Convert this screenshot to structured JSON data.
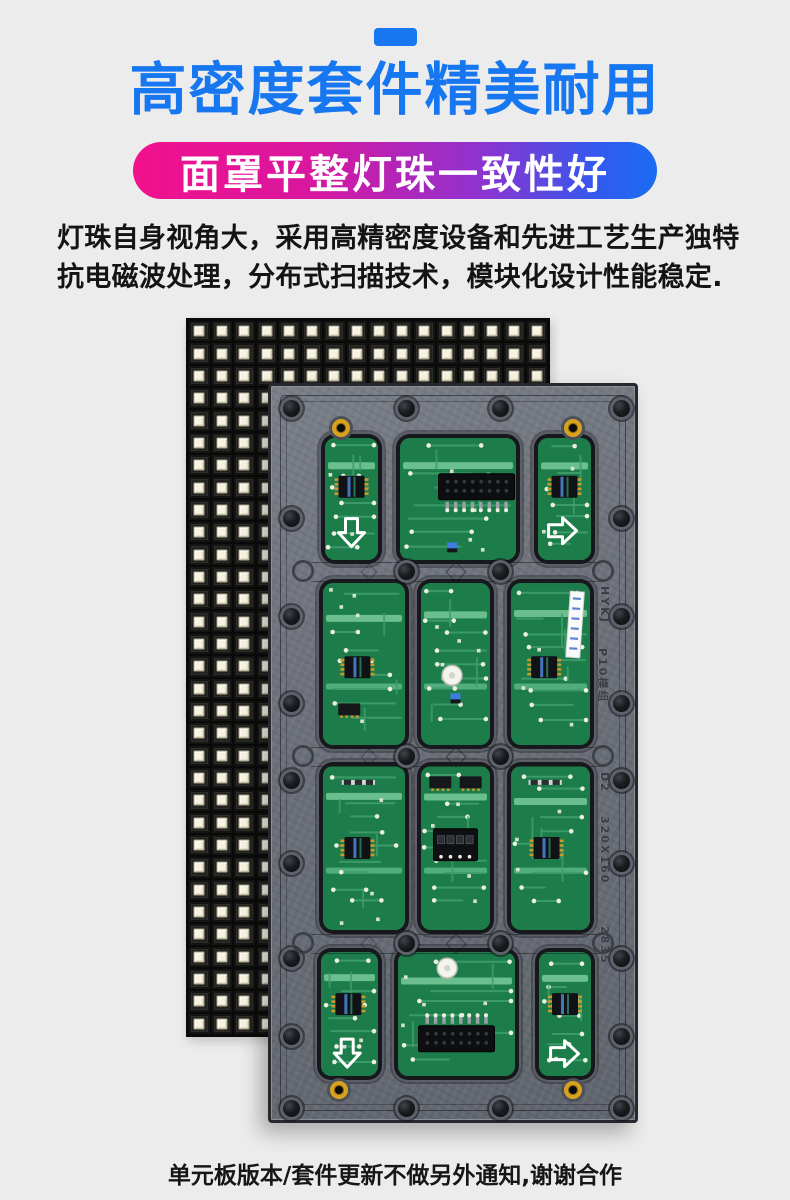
{
  "page": {
    "background": "#ececec"
  },
  "header": {
    "dash_color": "#1677f0",
    "title": "高密度套件精美耐用",
    "title_color": "#1677f0",
    "subtitle_pill": {
      "text": "面罩平整灯珠一致性好",
      "gradient": [
        "#f2108c",
        "#8f32cf",
        "#1b6cf2"
      ],
      "text_color": "#ffffff"
    },
    "description_line1": "灯珠自身视角大，采用高精密度设备和先进工艺生产独特",
    "description_line2": "抗电磁波处理，分布式扫描技术，模块化设计性能稳定."
  },
  "product_image": {
    "led_panel": {
      "cols": 16,
      "rows": 32,
      "led_color": "#f8f3e0",
      "body_color": "#151515"
    },
    "module_back": {
      "frame_color": "#6b6f78",
      "pcb_color": "#1f8550",
      "markings": [
        "HYKJ",
        "P10模组",
        "D2",
        "320X160",
        "2835"
      ]
    }
  },
  "footer": {
    "note": "单元板版本/套件更新不做另外通知,谢谢合作"
  }
}
